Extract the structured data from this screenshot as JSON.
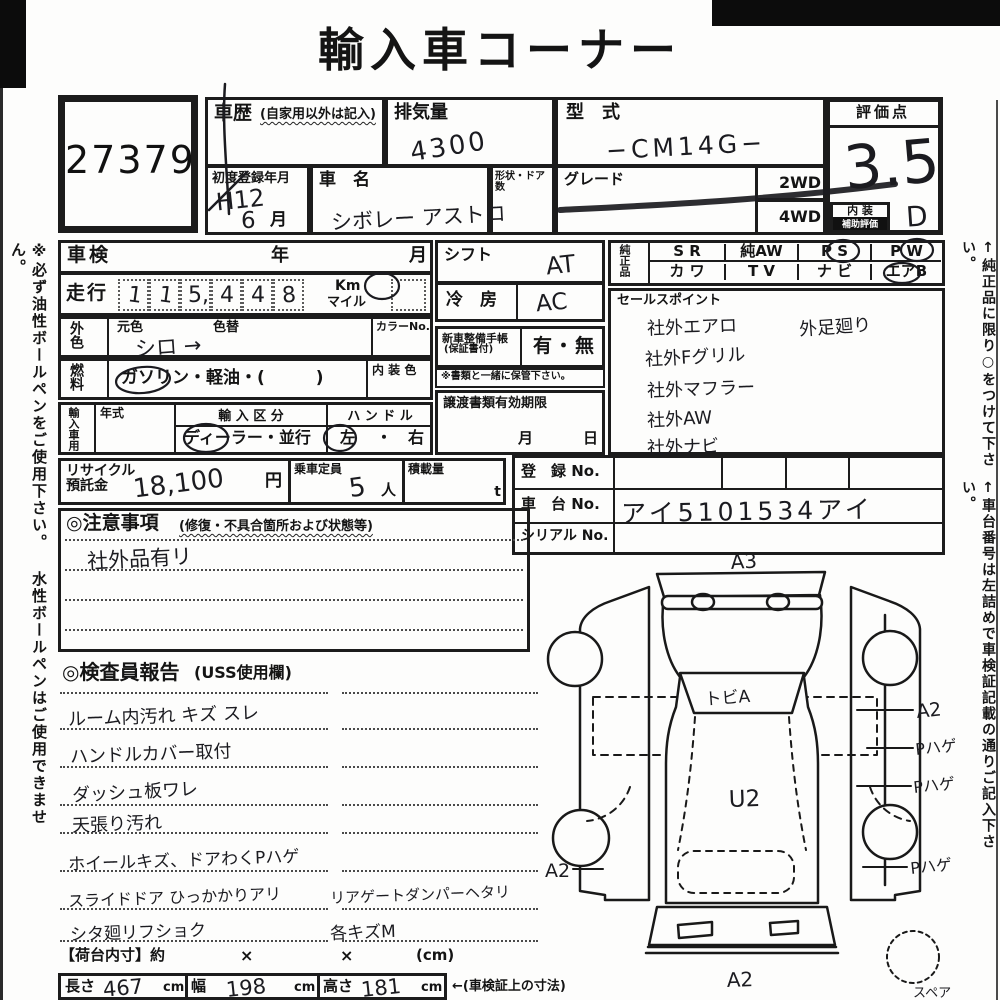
{
  "title": "輸入車コーナー",
  "lot_no": "27379",
  "header": {
    "history_label": "車歴",
    "history_note": "(自家用以外は記入)",
    "displacement_label": "排気量",
    "displacement_value": "4300",
    "model_label": "型　式",
    "model_value": "−CM14G−",
    "first_reg_label": "初度登録年月",
    "first_reg_era": "H12",
    "first_reg_month": "6",
    "month_suffix": "月",
    "name_label": "車　名",
    "name_value": "シボレー アストロ",
    "shape_label": "形状・ドア数",
    "grade_label": "グレード",
    "wd2": "2WD",
    "wd4": "4WD",
    "score_label": "評価点",
    "score_value": "3.5",
    "interior_row1": "内 装",
    "interior_row2": "補助評価",
    "interior_score": "D"
  },
  "left": {
    "shaken_label": "車検",
    "year": "年",
    "month": "月",
    "mileage_label": "走行",
    "digits": [
      "1",
      "1",
      "5,",
      "4",
      "4",
      "8",
      ""
    ],
    "km": "Km",
    "mile": "マイル",
    "color_label": "外色",
    "orig_color": "元色",
    "recolor": "色替",
    "color_value": "シロ →",
    "color_no": "カラーNo.",
    "fuel_label": "燃料",
    "fuel_options": "ガソリン・軽油・(　　　)",
    "interior_color": "内 装 色",
    "import_label": "輸入車用",
    "year_model": "年式",
    "import_class": "輸 入 区 分",
    "import_options": "ディーラー・並行",
    "handle": "ハ ン ド ル",
    "handle_left": "左",
    "handle_dot": "・",
    "handle_right": "右"
  },
  "middle": {
    "shift_label": "シフト",
    "shift_value": "AT",
    "cool_label": "冷　房",
    "cool_value": "AC",
    "book_label": "新車整備手帳",
    "book_note": "(保証書付)",
    "book_options": "有・無",
    "keep_note": "※書類と一緒に保管下さい。",
    "transfer_label": "譲渡書類有効期限",
    "transfer_month": "月",
    "transfer_day": "日"
  },
  "genuine": {
    "label": "純正品",
    "r1": [
      "S R",
      "純AW",
      "P S",
      "P W"
    ],
    "r2": [
      "カ ワ",
      "T V",
      "ナ ビ",
      "エアB"
    ]
  },
  "sales": {
    "label": "セールスポイント",
    "items": [
      "社外エアロ",
      "社外Fグリル",
      "社外マフラー",
      "社外AW",
      "社外ナビ"
    ],
    "note": "外足廻り"
  },
  "recycle": {
    "label1": "リサイクル",
    "label2": "預託金",
    "value": "18,100",
    "unit": "円",
    "cap_label": "乗車定員",
    "cap_value": "5",
    "cap_unit": "人",
    "load_label": "積載量",
    "load_unit": "t"
  },
  "reg": {
    "reg_label": "登　録 No.",
    "chassis_label": "車　台 No.",
    "chassis_value": "アイ5101534アイ",
    "serial_label": "シリアル No."
  },
  "notes": {
    "title": "◎注意事項",
    "subtitle": "(修復・不具合箇所および状態等)",
    "entry": "社外品有リ"
  },
  "inspection": {
    "title": "◎検査員報告",
    "subtitle": "(USS使用欄)",
    "rows": [
      {
        "left": "ルーム内汚れ キズ スレ",
        "right": ""
      },
      {
        "left": "ハンドルカバー取付",
        "right": ""
      },
      {
        "left": "ダッシュ板ワレ",
        "right": ""
      },
      {
        "left": "天張り汚れ",
        "right": ""
      },
      {
        "left": "ホイールキズ、ドアわくPハゲ",
        "right": ""
      },
      {
        "left": "スライドドア ひっかかりアリ",
        "right": "リアゲートダンパーヘタリ"
      },
      {
        "left": "シタ廻リフショク",
        "right": "各キズM"
      }
    ]
  },
  "diagram": {
    "a3": "A3",
    "windshield": "トビA",
    "center": "U2",
    "right1": "A2",
    "right2": "Pハゲ",
    "right3": "Pハゲ",
    "right4": "Pハゲ",
    "left1": "A2",
    "bottom": "A2",
    "spare": "スペア"
  },
  "bottom": {
    "cargo": "【荷台内寸】約",
    "x1": "×",
    "x2": "×",
    "cm": "(cm)",
    "len_label": "長さ",
    "len": "467",
    "w_label": "幅",
    "w": "198",
    "h_label": "高さ",
    "h": "181",
    "unit": "cm",
    "note": "←(車検証上の寸法)"
  },
  "margins": {
    "left": "※必ず油性ボールペンをご使用下さい。 水性ボールペンはご使用できません。",
    "right1": "↑純正品に限り○をつけて下さい。",
    "right2": "↑車台番号は左詰めで車検証記載の通りご記入下さい。"
  }
}
